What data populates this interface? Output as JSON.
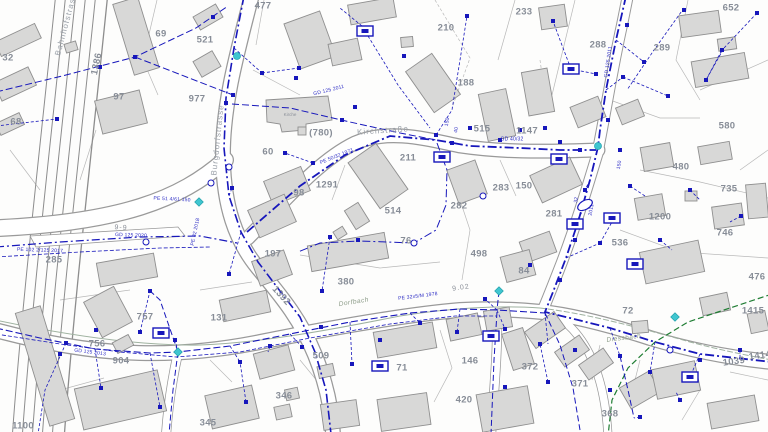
{
  "map": {
    "title": "utility-cadastre-map",
    "colors": {
      "utility_blue": "#1717bb",
      "teal": "#3fc6d0",
      "green_line": "#1f7d33",
      "building_fill": "#d8d8d7",
      "building_stroke": "#8f8f8f",
      "parcel_line": "#b8b8b8",
      "road_edge": "#9a9a9a",
      "label_gray": "#878d97",
      "stream": "#9fb2a0"
    },
    "parcel_labels": [
      {
        "t": "32",
        "x": 8,
        "y": 58
      },
      {
        "t": "68",
        "x": 16,
        "y": 122
      },
      {
        "t": "69",
        "x": 161,
        "y": 34
      },
      {
        "t": "521",
        "x": 205,
        "y": 40
      },
      {
        "t": "477",
        "x": 263,
        "y": 6
      },
      {
        "t": "97",
        "x": 119,
        "y": 97
      },
      {
        "t": "977",
        "x": 197,
        "y": 99
      },
      {
        "t": "1386",
        "x": 97,
        "y": 64,
        "r": -78
      },
      {
        "t": "233",
        "x": 524,
        "y": 12
      },
      {
        "t": "652",
        "x": 731,
        "y": 8
      },
      {
        "t": "210",
        "x": 446,
        "y": 28
      },
      {
        "t": "288",
        "x": 598,
        "y": 45
      },
      {
        "t": "289",
        "x": 662,
        "y": 48
      },
      {
        "t": "188",
        "x": 466,
        "y": 83
      },
      {
        "t": "(780)",
        "x": 321,
        "y": 133
      },
      {
        "t": "60",
        "x": 268,
        "y": 152
      },
      {
        "t": "515",
        "x": 482,
        "y": 129
      },
      {
        "t": "1147",
        "x": 527,
        "y": 131
      },
      {
        "t": "580",
        "x": 727,
        "y": 126
      },
      {
        "t": "211",
        "x": 408,
        "y": 158
      },
      {
        "t": "98",
        "x": 299,
        "y": 193
      },
      {
        "t": "1291",
        "x": 327,
        "y": 185
      },
      {
        "t": "514",
        "x": 393,
        "y": 211
      },
      {
        "t": "283",
        "x": 501,
        "y": 188
      },
      {
        "t": "150",
        "x": 524,
        "y": 186
      },
      {
        "t": "282",
        "x": 459,
        "y": 206
      },
      {
        "t": "281",
        "x": 554,
        "y": 214
      },
      {
        "t": "480",
        "x": 681,
        "y": 167
      },
      {
        "t": "735",
        "x": 729,
        "y": 189
      },
      {
        "t": "1200",
        "x": 660,
        "y": 217
      },
      {
        "t": "746",
        "x": 725,
        "y": 233
      },
      {
        "t": "536",
        "x": 620,
        "y": 243
      },
      {
        "t": "76",
        "x": 406,
        "y": 241
      },
      {
        "t": "498",
        "x": 479,
        "y": 254
      },
      {
        "t": "197",
        "x": 273,
        "y": 254
      },
      {
        "t": "285",
        "x": 54,
        "y": 260
      },
      {
        "t": "380",
        "x": 346,
        "y": 282
      },
      {
        "t": "84",
        "x": 524,
        "y": 271
      },
      {
        "t": "476",
        "x": 757,
        "y": 277
      },
      {
        "t": "757",
        "x": 145,
        "y": 317
      },
      {
        "t": "131",
        "x": 219,
        "y": 318
      },
      {
        "t": "756",
        "x": 97,
        "y": 344
      },
      {
        "t": "904",
        "x": 121,
        "y": 361
      },
      {
        "t": "72",
        "x": 628,
        "y": 311
      },
      {
        "t": "1415",
        "x": 753,
        "y": 311
      },
      {
        "t": "1392",
        "x": 281,
        "y": 296,
        "r": 48
      },
      {
        "t": "345",
        "x": 208,
        "y": 423
      },
      {
        "t": "1100",
        "x": 23,
        "y": 426
      },
      {
        "t": "346",
        "x": 284,
        "y": 396
      },
      {
        "t": "509",
        "x": 321,
        "y": 356
      },
      {
        "t": "71",
        "x": 402,
        "y": 368
      },
      {
        "t": "146",
        "x": 470,
        "y": 361
      },
      {
        "t": "372",
        "x": 530,
        "y": 367
      },
      {
        "t": "371",
        "x": 580,
        "y": 384
      },
      {
        "t": "368",
        "x": 610,
        "y": 414
      },
      {
        "t": "420",
        "x": 464,
        "y": 400
      },
      {
        "t": "1039",
        "x": 734,
        "y": 362,
        "r": -8
      },
      {
        "t": "1414",
        "x": 760,
        "y": 356,
        "r": -8
      }
    ],
    "street_labels": [
      {
        "t": "Bahnhofstrasse",
        "x": 67,
        "y": 22,
        "r": -75
      },
      {
        "t": "Burgdorfstrasse",
        "x": 218,
        "y": 140,
        "r": -84
      },
      {
        "t": "Kirchstraße",
        "x": 383,
        "y": 131,
        "r": -4
      }
    ],
    "stream_labels": [
      {
        "t": "Dorfbach",
        "x": 354,
        "y": 303,
        "r": -9
      },
      {
        "t": "Diessbach",
        "x": 624,
        "y": 339,
        "r": -7
      }
    ],
    "pipe_labels": [
      {
        "t": "GD 125 2011",
        "x": 329,
        "y": 91,
        "r": -14
      },
      {
        "t": "PE 50/32 1971",
        "x": 337,
        "y": 157,
        "r": -22
      },
      {
        "t": "GD 125 2020",
        "x": 131,
        "y": 236,
        "r": 2
      },
      {
        "t": "PE 102 2/125 2017",
        "x": 40,
        "y": 251,
        "r": 2
      },
      {
        "t": "GD 125 2013",
        "x": 90,
        "y": 353,
        "r": 7
      },
      {
        "t": "PE 51 4/61 150",
        "x": 172,
        "y": 200,
        "r": 3
      },
      {
        "t": "PE 32 2018",
        "x": 196,
        "y": 232,
        "r": -78
      },
      {
        "t": "GD 125 2011",
        "x": 609,
        "y": 62,
        "r": -82
      },
      {
        "t": "PE 32x5/M 1978",
        "x": 418,
        "y": 297,
        "r": -7
      },
      {
        "t": "GD 40/32",
        "x": 512,
        "y": 140,
        "r": 0
      },
      {
        "t": "150",
        "x": 448,
        "y": 122,
        "r": -80
      },
      {
        "t": "40",
        "x": 457,
        "y": 130,
        "r": -80
      },
      {
        "t": "32",
        "x": 577,
        "y": 200,
        "r": -80
      },
      {
        "t": "2011",
        "x": 592,
        "y": 210,
        "r": -80
      },
      {
        "t": "150",
        "x": 620,
        "y": 165,
        "r": -80
      }
    ],
    "road_marks": [
      {
        "t": "9-9",
        "x": 121,
        "y": 228,
        "r": 3
      },
      {
        "t": "9.02",
        "x": 461,
        "y": 288,
        "r": -8
      }
    ],
    "building_labels": [
      {
        "t": "Kirche",
        "x": 290,
        "y": 115
      }
    ],
    "symbols": {
      "valve_stations": [
        [
          365,
          31
        ],
        [
          571,
          69
        ],
        [
          442,
          157
        ],
        [
          559,
          159
        ],
        [
          575,
          224
        ],
        [
          612,
          218
        ],
        [
          635,
          264
        ],
        [
          161,
          333
        ],
        [
          380,
          366
        ],
        [
          491,
          336
        ],
        [
          690,
          377
        ]
      ],
      "hydrant_circles": [
        [
          237,
          56
        ],
        [
          598,
          146
        ]
      ],
      "hydrant_diamonds": [
        [
          178,
          352
        ],
        [
          499,
          291
        ],
        [
          675,
          317
        ],
        [
          199,
          202
        ]
      ],
      "manholes": [
        [
          229,
          167
        ],
        [
          146,
          242
        ],
        [
          670,
          350
        ],
        [
          483,
          196
        ],
        [
          414,
          243
        ],
        [
          211,
          183
        ]
      ],
      "tanks": [
        [
          585,
          205,
          -30
        ]
      ],
      "nodes": [
        [
          135,
          57
        ],
        [
          213,
          17
        ],
        [
          233,
          95
        ],
        [
          226,
          103
        ],
        [
          232,
          188
        ],
        [
          262,
          73
        ],
        [
          299,
          68
        ],
        [
          355,
          107
        ],
        [
          404,
          56
        ],
        [
          467,
          16
        ],
        [
          553,
          21
        ],
        [
          596,
          74
        ],
        [
          627,
          25
        ],
        [
          644,
          62
        ],
        [
          684,
          10
        ],
        [
          757,
          13
        ],
        [
          722,
          50
        ],
        [
          296,
          78
        ],
        [
          342,
          120
        ],
        [
          436,
          135
        ],
        [
          452,
          143
        ],
        [
          470,
          128
        ],
        [
          500,
          140
        ],
        [
          520,
          130
        ],
        [
          545,
          128
        ],
        [
          560,
          142
        ],
        [
          580,
          150
        ],
        [
          620,
          150
        ],
        [
          313,
          163
        ],
        [
          285,
          153
        ],
        [
          330,
          237
        ],
        [
          358,
          240
        ],
        [
          322,
          291
        ],
        [
          229,
          274
        ],
        [
          101,
          388
        ],
        [
          60,
          354
        ],
        [
          150,
          291
        ],
        [
          585,
          190
        ],
        [
          575,
          240
        ],
        [
          560,
          280
        ],
        [
          530,
          265
        ],
        [
          600,
          243
        ],
        [
          630,
          186
        ],
        [
          690,
          190
        ],
        [
          660,
          240
        ],
        [
          741,
          216
        ],
        [
          321,
          327
        ],
        [
          380,
          340
        ],
        [
          420,
          323
        ],
        [
          457,
          332
        ],
        [
          485,
          299
        ],
        [
          505,
          329
        ],
        [
          540,
          344
        ],
        [
          575,
          350
        ],
        [
          620,
          356
        ],
        [
          650,
          372
        ],
        [
          700,
          360
        ],
        [
          740,
          350
        ],
        [
          505,
          387
        ],
        [
          548,
          382
        ],
        [
          610,
          390
        ],
        [
          640,
          417
        ],
        [
          680,
          400
        ],
        [
          270,
          346
        ],
        [
          240,
          362
        ],
        [
          175,
          340
        ],
        [
          140,
          332
        ],
        [
          96,
          330
        ],
        [
          66,
          343
        ],
        [
          160,
          407
        ],
        [
          246,
          402
        ],
        [
          302,
          347
        ],
        [
          352,
          364
        ],
        [
          57,
          119
        ],
        [
          100,
          67
        ],
        [
          623,
          77
        ],
        [
          608,
          120
        ],
        [
          668,
          96
        ],
        [
          706,
          80
        ]
      ]
    }
  }
}
